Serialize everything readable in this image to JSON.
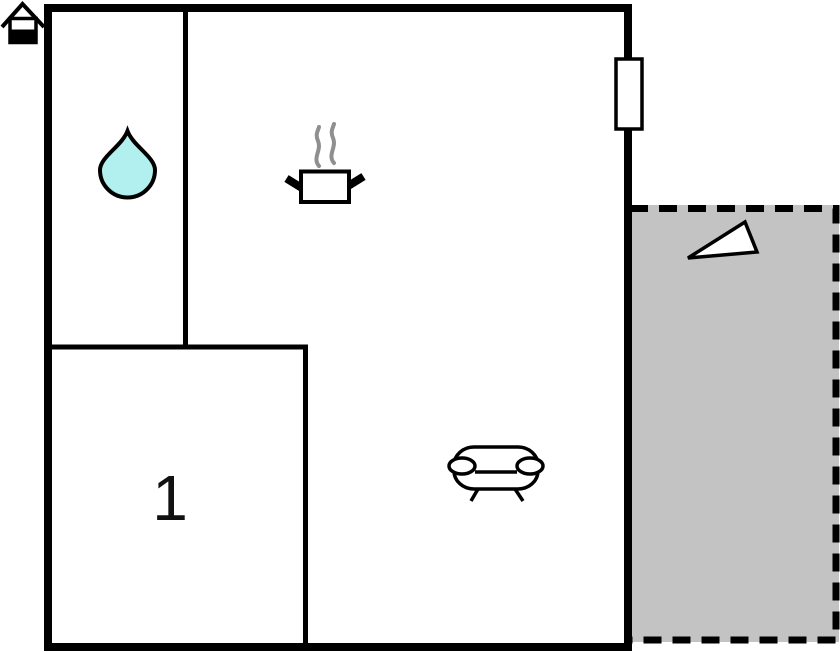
{
  "plan": {
    "name": "apartment-floor-plan",
    "rooms": {
      "bedroom": {
        "label": "1",
        "position": "bottom-left"
      },
      "bathroom": {
        "icon": "water-drop-icon",
        "position": "top-left"
      },
      "kitchen": {
        "icon": "cooking-pot-icon",
        "position": "top-middle"
      },
      "living_room": {
        "icon": "sofa-icon",
        "position": "bottom-middle"
      },
      "terrace": {
        "icon": "triangle-icon",
        "position": "right",
        "border": "dashed"
      }
    },
    "icons": {
      "entrance": "house-icon",
      "bathroom": "water-drop-icon",
      "kitchen": "cooking-pot-with-steam-icon",
      "living": "sofa-icon",
      "window": "window-icon",
      "terrace_marker": "triangle-icon"
    },
    "colors": {
      "wall": "#000000",
      "background": "#ffffff",
      "terrace_fill": "#c3c3c3",
      "water_drop_fill": "#b2f0f0",
      "steam": "#8f8f8f",
      "room_number": "#111111"
    }
  }
}
